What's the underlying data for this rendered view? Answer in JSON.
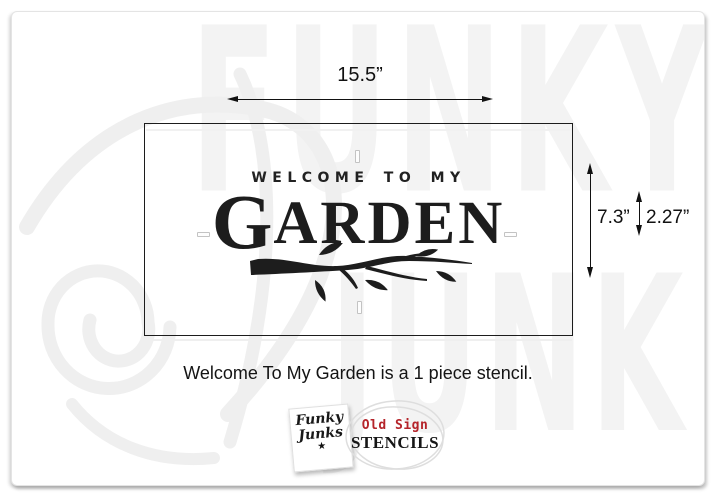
{
  "dimensions": {
    "width": "15.5”",
    "height": "7.3”",
    "letter_height": "2.27”"
  },
  "stencil": {
    "subtitle": "WELCOME TO MY",
    "title_initial": "G",
    "title_rest": "ARDEN"
  },
  "caption": "Welcome To My Garden is a 1 piece stencil.",
  "brand": {
    "note_line1": "Funky",
    "note_line2": "Junks",
    "note_star": "★",
    "badge_line1": "Old Sign",
    "badge_line2": "STENCILS"
  },
  "watermark": {
    "top_word": "FUNKY",
    "bottom_word": "JUNK"
  },
  "colors": {
    "stencil_ink": "#1d1d1d",
    "badge_red": "#b5242a",
    "watermark_gray": "#f3f3f3"
  }
}
